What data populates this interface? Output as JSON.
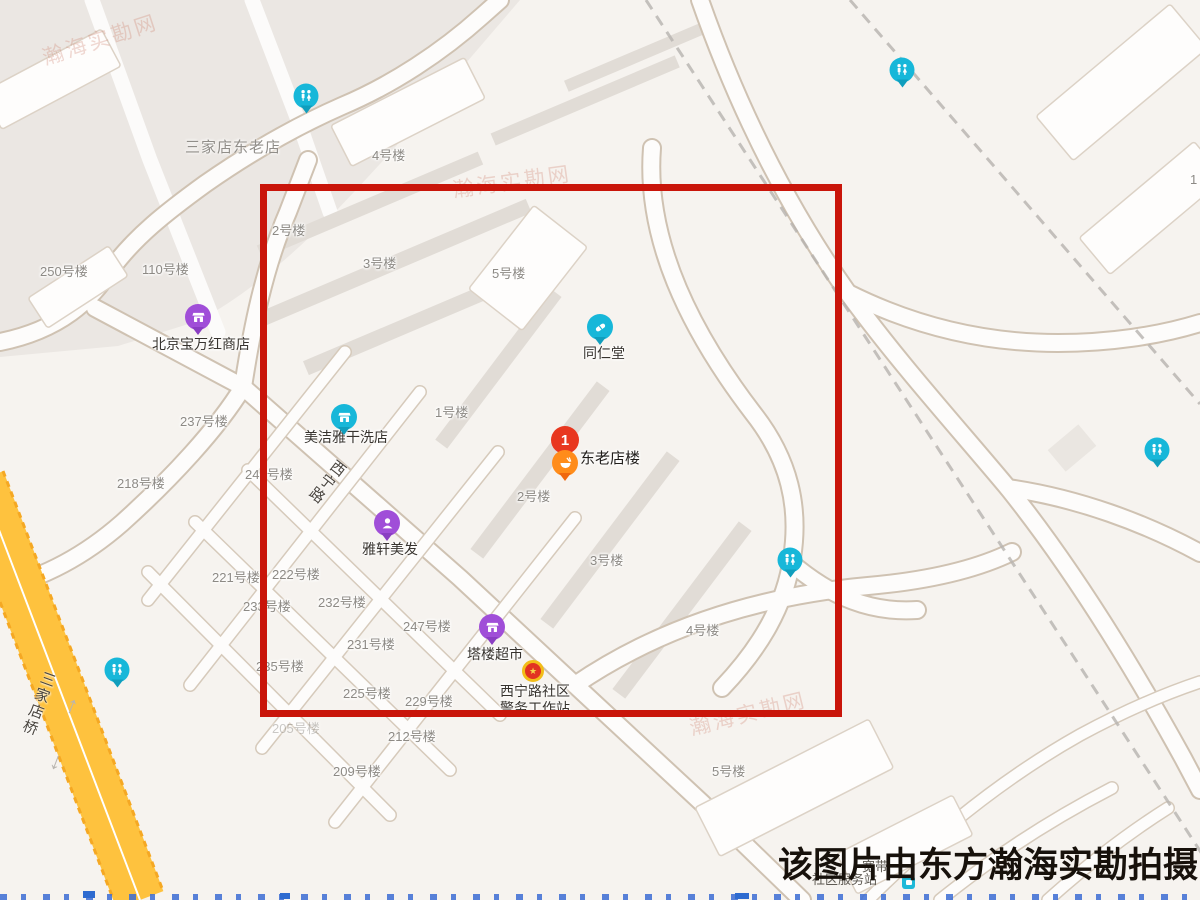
{
  "watermark": {
    "text": "该图片由东方瀚海实勘拍摄"
  },
  "area_label": {
    "text": "三家店东老店",
    "x": 185,
    "y": 136
  },
  "highlight": {
    "x": 260,
    "y": 184,
    "w": 582,
    "h": 533,
    "color": "#c9150a"
  },
  "colors": {
    "pin_cyan": "#17b7d9",
    "pin_cyan_dark": "#109ebd",
    "pin_purple": "#a04ed8",
    "pin_purple_dark": "#8a3ec2",
    "pin_orange": "#ff8c1a",
    "pin_orange_dark": "#f0680f",
    "pin_red": "#e8371f",
    "badge_gold": "#f2bd18",
    "badge_red": "#e23222",
    "yellow_road": "#fec23e"
  },
  "building_labels": [
    {
      "text": "250号楼",
      "x": 40,
      "y": 261
    },
    {
      "text": "110号楼",
      "x": 142,
      "y": 259
    },
    {
      "text": "4号楼",
      "x": 372,
      "y": 145
    },
    {
      "text": "2号楼",
      "x": 272,
      "y": 220
    },
    {
      "text": "3号楼",
      "x": 363,
      "y": 253
    },
    {
      "text": "5号楼",
      "x": 492,
      "y": 263
    },
    {
      "text": "237号楼",
      "x": 180,
      "y": 411
    },
    {
      "text": "218号楼",
      "x": 117,
      "y": 473
    },
    {
      "text": "247号楼",
      "x": 245,
      "y": 464
    },
    {
      "text": "1号楼",
      "x": 435,
      "y": 402
    },
    {
      "text": "221号楼",
      "x": 212,
      "y": 567
    },
    {
      "text": "222号楼",
      "x": 272,
      "y": 564
    },
    {
      "text": "233号楼",
      "x": 243,
      "y": 596
    },
    {
      "text": "232号楼",
      "x": 318,
      "y": 592
    },
    {
      "text": "247号楼",
      "x": 403,
      "y": 616
    },
    {
      "text": "231号楼",
      "x": 347,
      "y": 634
    },
    {
      "text": "235号楼",
      "x": 256,
      "y": 656
    },
    {
      "text": "225号楼",
      "x": 343,
      "y": 683
    },
    {
      "text": "229号楼",
      "x": 405,
      "y": 691
    },
    {
      "text": "205号楼",
      "x": 272,
      "y": 718,
      "opacity": 0.45
    },
    {
      "text": "212号楼",
      "x": 388,
      "y": 726
    },
    {
      "text": "209号楼",
      "x": 333,
      "y": 761
    },
    {
      "text": "2号楼",
      "x": 517,
      "y": 486
    },
    {
      "text": "3号楼",
      "x": 590,
      "y": 550
    },
    {
      "text": "4号楼",
      "x": 686,
      "y": 620
    },
    {
      "text": "5号楼",
      "x": 712,
      "y": 761
    },
    {
      "text": "1",
      "x": 1190,
      "y": 172
    }
  ],
  "road_labels": [
    {
      "text": "西宁路",
      "x": 334,
      "y": 455,
      "angle": 38
    },
    {
      "text": "三家店桥",
      "x": 40,
      "y": 668,
      "angle": 20
    }
  ],
  "pois": [
    {
      "name": "beijing-baowanhong-store",
      "label": "北京宝万红商店",
      "icon": "storefront",
      "color": "purple",
      "pin": [
        198,
        317
      ],
      "label_pos": [
        152,
        336
      ]
    },
    {
      "name": "meijieya-drycleaner",
      "label": "美洁雅干洗店",
      "icon": "storefront",
      "color": "cyan",
      "pin": [
        344,
        417
      ],
      "label_pos": [
        304,
        429
      ]
    },
    {
      "name": "tongrentang-pharmacy",
      "label": "同仁堂",
      "icon": "pill",
      "color": "cyan",
      "pin": [
        600,
        327
      ],
      "label_pos": [
        583,
        345
      ]
    },
    {
      "name": "donglaodianlou",
      "label": "东老店楼",
      "icon": "bowl",
      "color": "orange",
      "pin": [
        565,
        463
      ],
      "label_pos": [
        580,
        450
      ],
      "big": true
    },
    {
      "name": "yaxuan-salon",
      "label": "雅轩美发",
      "icon": "person",
      "color": "purple",
      "pin": [
        387,
        523
      ],
      "label_pos": [
        362,
        541
      ]
    },
    {
      "name": "talou-supermarket",
      "label": "塔楼超市",
      "icon": "storefront",
      "color": "purple",
      "pin": [
        492,
        627
      ],
      "label_pos": [
        467,
        646
      ]
    },
    {
      "name": "xining-road-police-station",
      "label": "西宁路社区\n警务工作站",
      "icon": "badge",
      "color": "badge",
      "pin": [
        533,
        671
      ],
      "label_pos": [
        500,
        683
      ]
    }
  ],
  "toilet_pins": [
    [
      306,
      96
    ],
    [
      117,
      670
    ],
    [
      790,
      560
    ],
    [
      902,
      70
    ],
    [
      1157,
      450
    ]
  ],
  "numbered_marker": {
    "label": "1",
    "pos": [
      565,
      440
    ]
  },
  "hidden_labels": [
    {
      "text": "宽带",
      "x": 862,
      "y": 856
    },
    {
      "text": "社区服务站",
      "x": 812,
      "y": 869
    }
  ],
  "community_icon": {
    "pos": [
      902,
      876
    ]
  },
  "faint_watermarks": [
    {
      "text": "瀚海实勘网",
      "x": 40,
      "y": 24,
      "angle": -18
    },
    {
      "text": "瀚海实勘网",
      "x": 452,
      "y": 166,
      "angle": -8
    },
    {
      "text": "瀚海实勘网",
      "x": 688,
      "y": 698,
      "angle": -14
    }
  ],
  "road_arrows": [
    {
      "glyph": "↑",
      "x": 66,
      "y": 692
    },
    {
      "glyph": "↓",
      "x": 50,
      "y": 748
    }
  ]
}
